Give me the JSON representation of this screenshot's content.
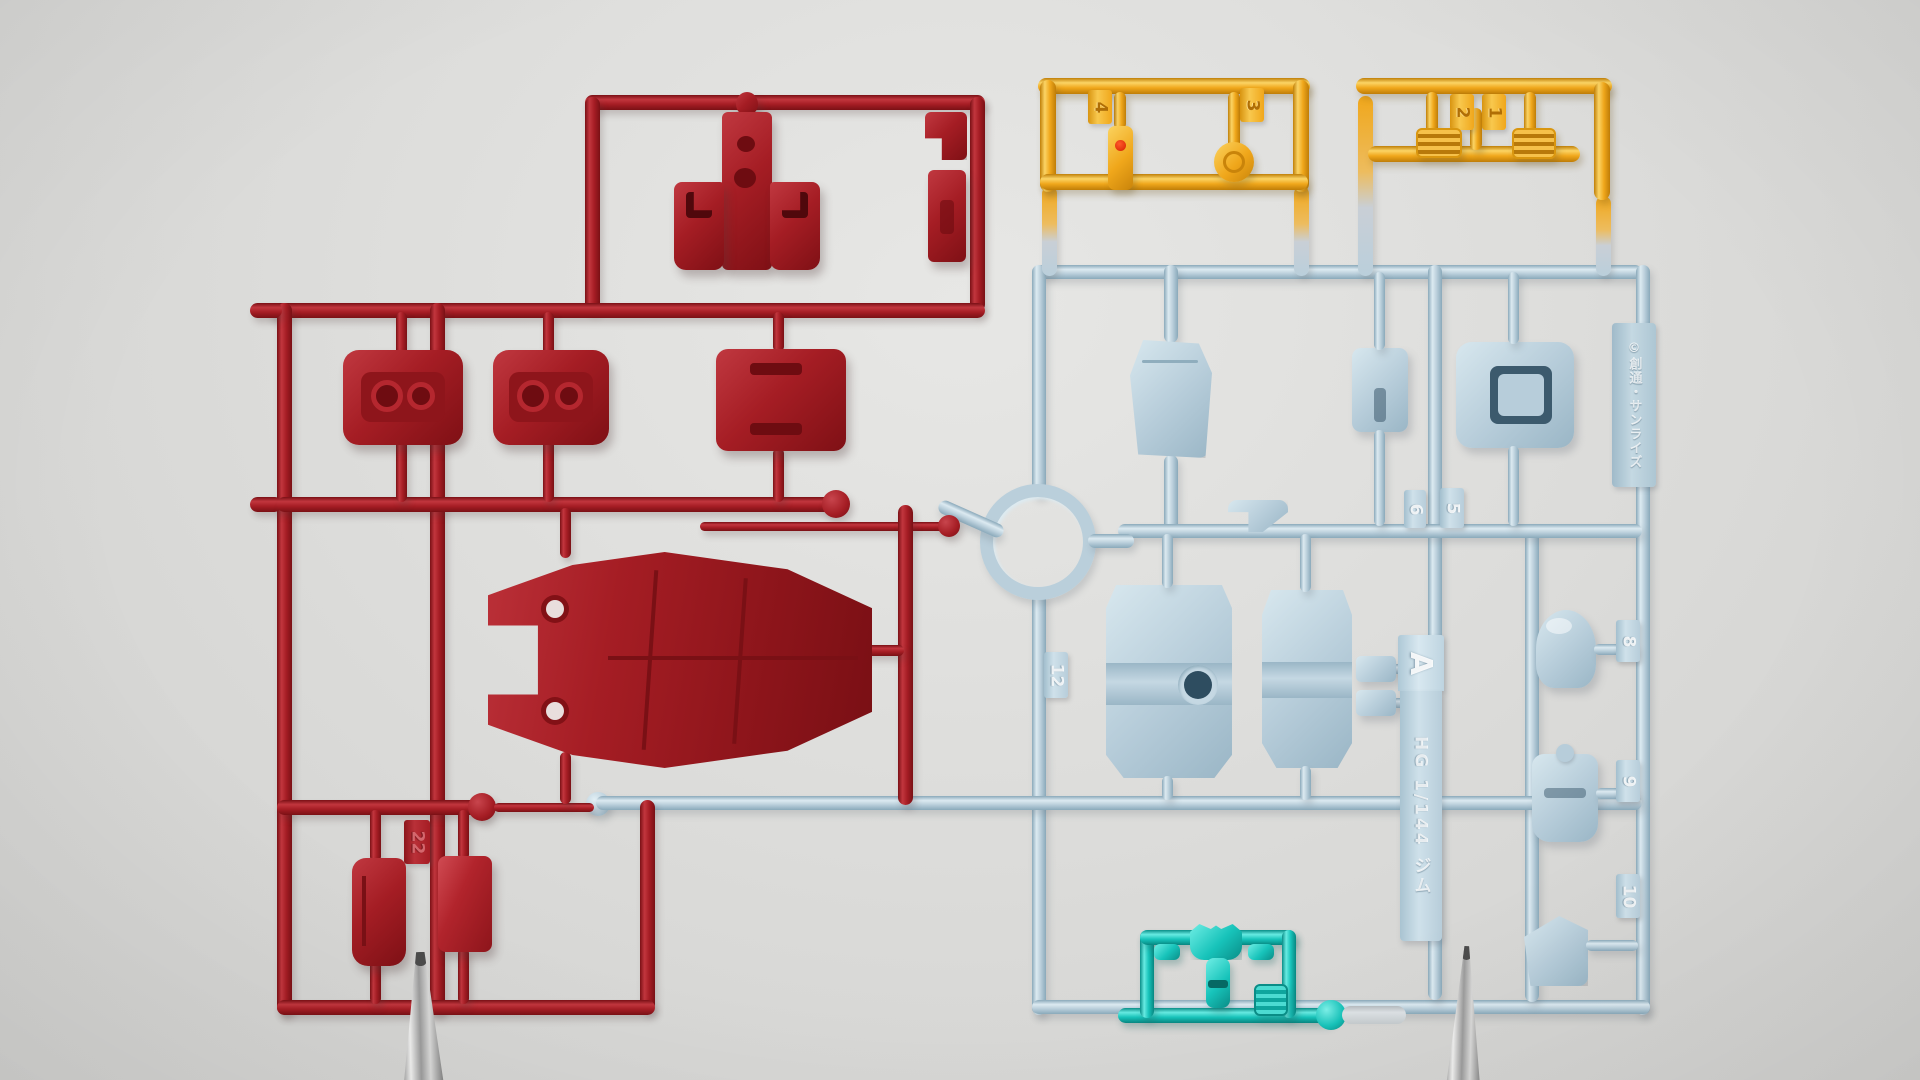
{
  "scene": {
    "description": "Photograph of injection-molded plastic model-kit runners (sprues): one dark-red runner, one pale-blue runner with co-molded yellow sections and a clear-teal section, held upright by two metal clamps",
    "kit_label": {
      "runner_letter": "A",
      "kit_name": "HG 1/144 ジム",
      "copyright": "©創通・サンライズ"
    }
  },
  "gate_numbers": {
    "yellow_right_sprue": [
      "1",
      "2"
    ],
    "yellow_left_sprue": [
      "3",
      "4"
    ],
    "blue_sprue": [
      "5",
      "6",
      "8",
      "9",
      "10",
      "12"
    ],
    "red_sprue": [
      "22"
    ]
  },
  "colors": {
    "red_plastic": "#a51d24",
    "blue_plastic": "#b7cdda",
    "yellow_plastic": "#f0a71b",
    "teal_plastic": "#17c3ba",
    "background": "#dcdcda",
    "clamp_metal": "#9c9c9c"
  }
}
